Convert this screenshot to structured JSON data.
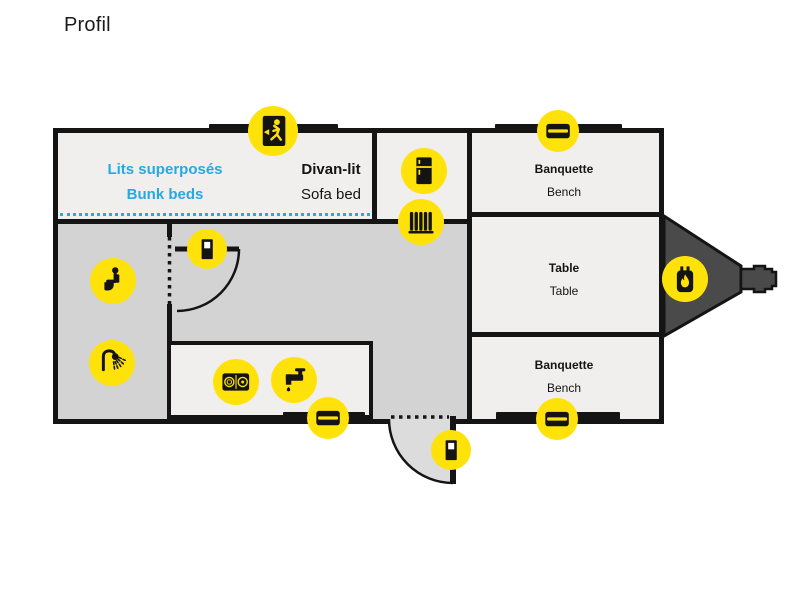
{
  "title": "Profil",
  "floorplan": {
    "rooms": {
      "bunk_beds": {
        "fr": "Lits superposés",
        "en": "Bunk beds"
      },
      "sofa_bed": {
        "fr": "Divan-lit",
        "en": "Sofa bed"
      },
      "bench_front": {
        "fr": "Banquette",
        "en": "Bench"
      },
      "dinette_table": {
        "fr": "Table",
        "en": "Table"
      },
      "bench_rear": {
        "fr": "Banquette",
        "en": "Bench"
      }
    },
    "icons": [
      {
        "name": "emergency-exit-window-icon",
        "meaning": "emergency exit window",
        "glyph": "running person in doorway"
      },
      {
        "name": "storage-icon-top",
        "meaning": "exterior storage hatch",
        "glyph": "black hatch with slot"
      },
      {
        "name": "fridge-icon",
        "meaning": "refrigerator",
        "glyph": "fridge silhouette"
      },
      {
        "name": "heater-icon",
        "meaning": "heater / furnace",
        "glyph": "radiator bars"
      },
      {
        "name": "propane-tank-icon",
        "meaning": "propane furnace on hitch",
        "glyph": "tank with flame"
      },
      {
        "name": "toilet-icon",
        "meaning": "toilet",
        "glyph": "seated person"
      },
      {
        "name": "shower-icon",
        "meaning": "shower",
        "glyph": "shower head spray"
      },
      {
        "name": "interior-door-icon",
        "meaning": "bathroom door",
        "glyph": "door with window"
      },
      {
        "name": "stove-icon",
        "meaning": "two-burner cooktop",
        "glyph": "cooktop"
      },
      {
        "name": "faucet-icon",
        "meaning": "sink faucet",
        "glyph": "tap with drip"
      },
      {
        "name": "storage-icon-bottom-left",
        "meaning": "exterior storage hatch",
        "glyph": "black hatch with slot"
      },
      {
        "name": "storage-icon-bottom-right",
        "meaning": "exterior storage hatch",
        "glyph": "black hatch with slot"
      },
      {
        "name": "entry-door-icon",
        "meaning": "entry door",
        "glyph": "door with window"
      }
    ],
    "colors": {
      "accent_yellow": "#FFE20A",
      "accent_cyan": "#29A8E0",
      "wall_black": "#141414",
      "floor_light": "#F0EFEE",
      "floor_gray": "#D3D3D3",
      "hitch_gray": "#4A4A4A"
    }
  }
}
